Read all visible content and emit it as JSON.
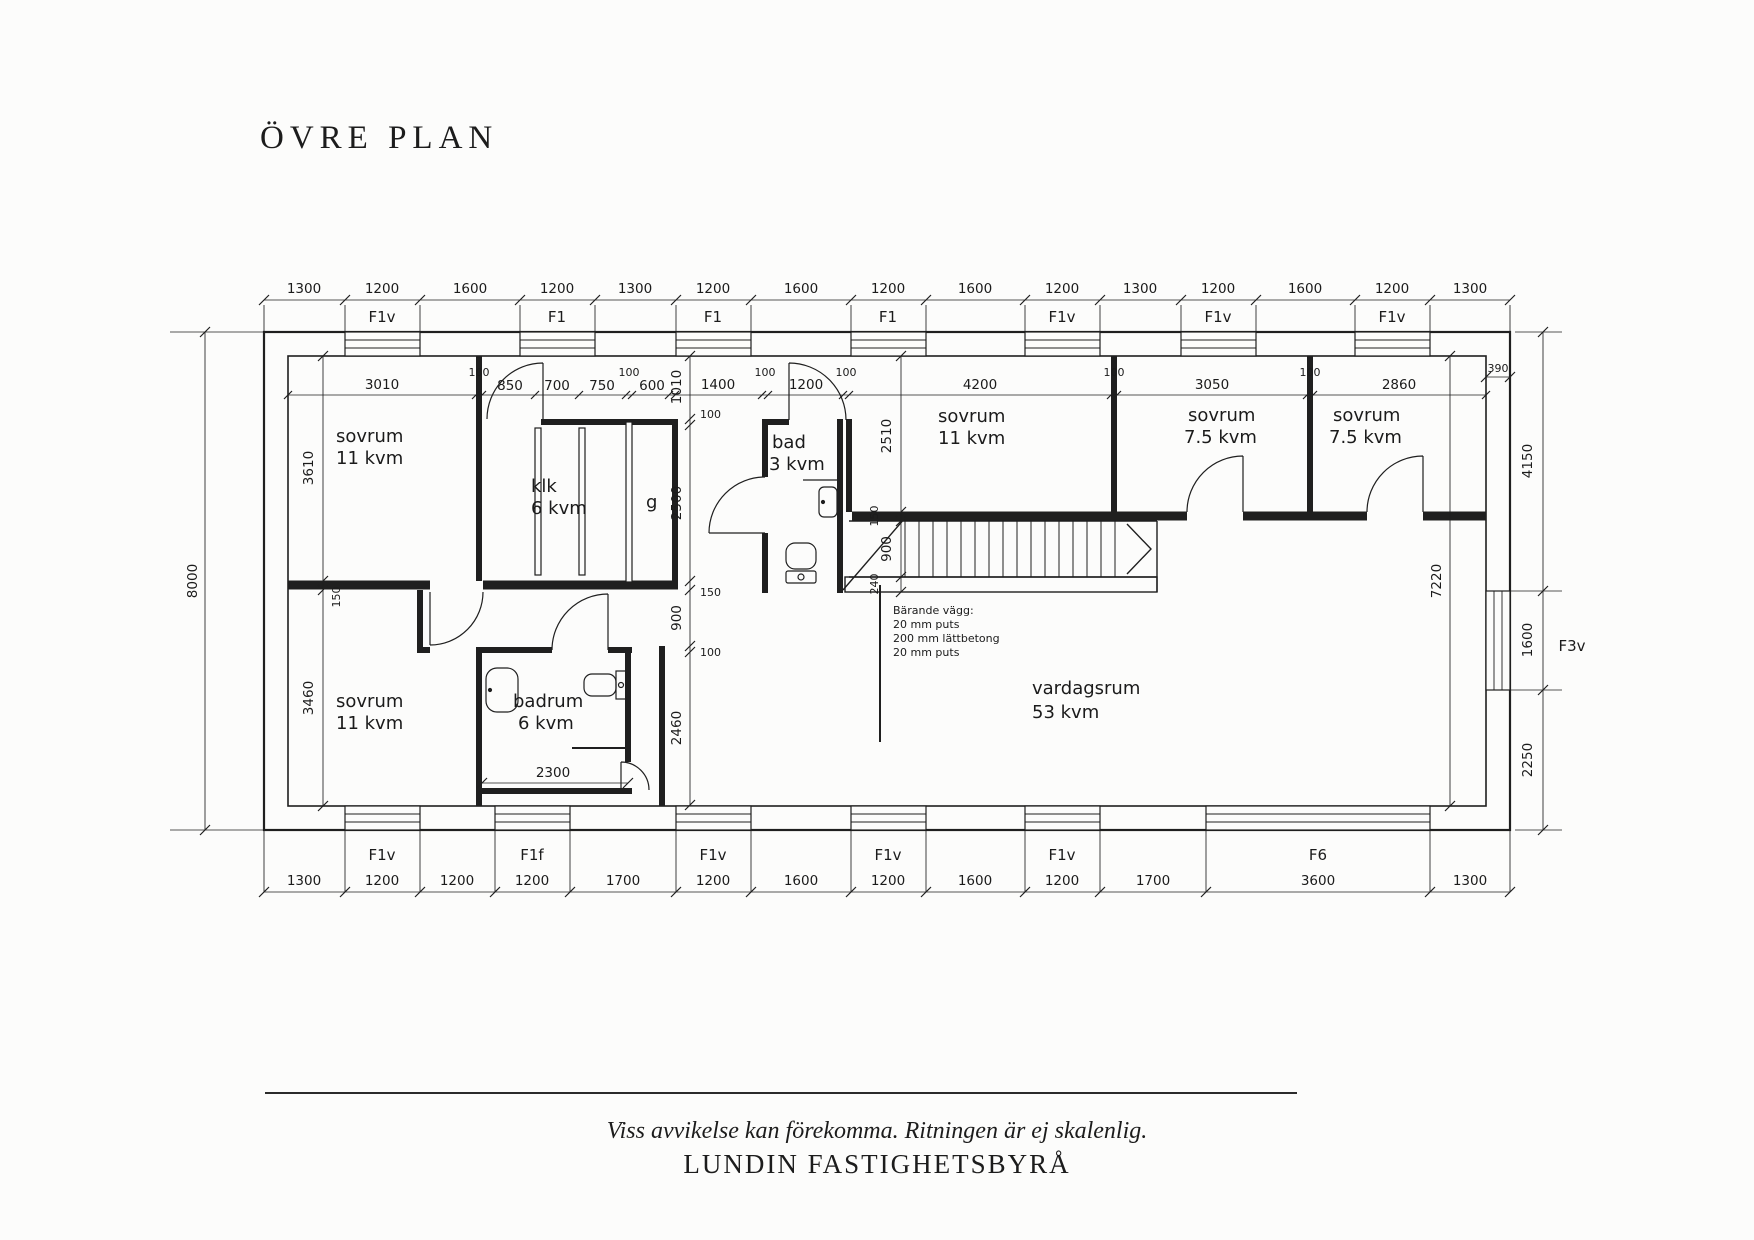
{
  "title": "ÖVRE PLAN",
  "colors": {
    "ink": "#1f1f1f",
    "paper": "#fcfcfb"
  },
  "plan": {
    "dims": {
      "top_outer": [
        "1300",
        "1200",
        "1600",
        "1200",
        "1300",
        "1200",
        "1600",
        "1200",
        "1600",
        "1200",
        "1300",
        "1200",
        "1600",
        "1200",
        "1300"
      ],
      "top_window_labels": [
        "F1v",
        "F1",
        "F1",
        "F1",
        "F1v",
        "F1v",
        "F1v"
      ],
      "interior_top": [
        "3010",
        "100",
        "850",
        "700",
        "750",
        "100",
        "600",
        "1400",
        "100",
        "1200",
        "100",
        "4200",
        "100",
        "3050",
        "100",
        "2860"
      ],
      "corner": "390",
      "bottom_outer": [
        "1300",
        "1200",
        "1200",
        "1200",
        "1700",
        "1200",
        "1600",
        "1200",
        "1600",
        "1200",
        "1700",
        "3600",
        "1300"
      ],
      "bottom_window_labels": [
        "F1v",
        "F1f",
        "F1v",
        "F1v",
        "F1v",
        "F6"
      ],
      "left_total": "8000",
      "left_interior": [
        "3610",
        "150",
        "3460"
      ],
      "mid_chain": [
        "1010",
        "100",
        "2500",
        "150",
        "900",
        "100",
        "2460"
      ],
      "stair_chain": [
        "2510",
        "150",
        "900",
        "240"
      ],
      "right_chain": [
        "4150",
        "1600",
        "2250"
      ],
      "right_window_label": "F3v",
      "interior_height": "7220",
      "badrum_width": "2300"
    },
    "rooms": [
      {
        "name": "sovrum",
        "area": "11 kvm"
      },
      {
        "name": "klk",
        "area": "6 kvm"
      },
      {
        "name": "g",
        "area": ""
      },
      {
        "name": "bad",
        "area": "3 kvm"
      },
      {
        "name": "sovrum",
        "area": "11 kvm"
      },
      {
        "name": "sovrum",
        "area": "7.5 kvm"
      },
      {
        "name": "sovrum",
        "area": "7.5 kvm"
      },
      {
        "name": "sovrum",
        "area": "11 kvm"
      },
      {
        "name": "badrum",
        "area": "6 kvm"
      },
      {
        "name": "vardagsrum",
        "area": "53 kvm"
      }
    ],
    "annotation": {
      "line1": "Bärande vägg:",
      "line2": "20 mm puts",
      "line3": "200 mm lättbetong",
      "line4": "20 mm puts"
    }
  },
  "footer": {
    "disclaimer": "Viss avvikelse kan förekomma. Ritningen är ej skalenlig.",
    "agency": "LUNDIN FASTIGHETSBYRÅ"
  }
}
